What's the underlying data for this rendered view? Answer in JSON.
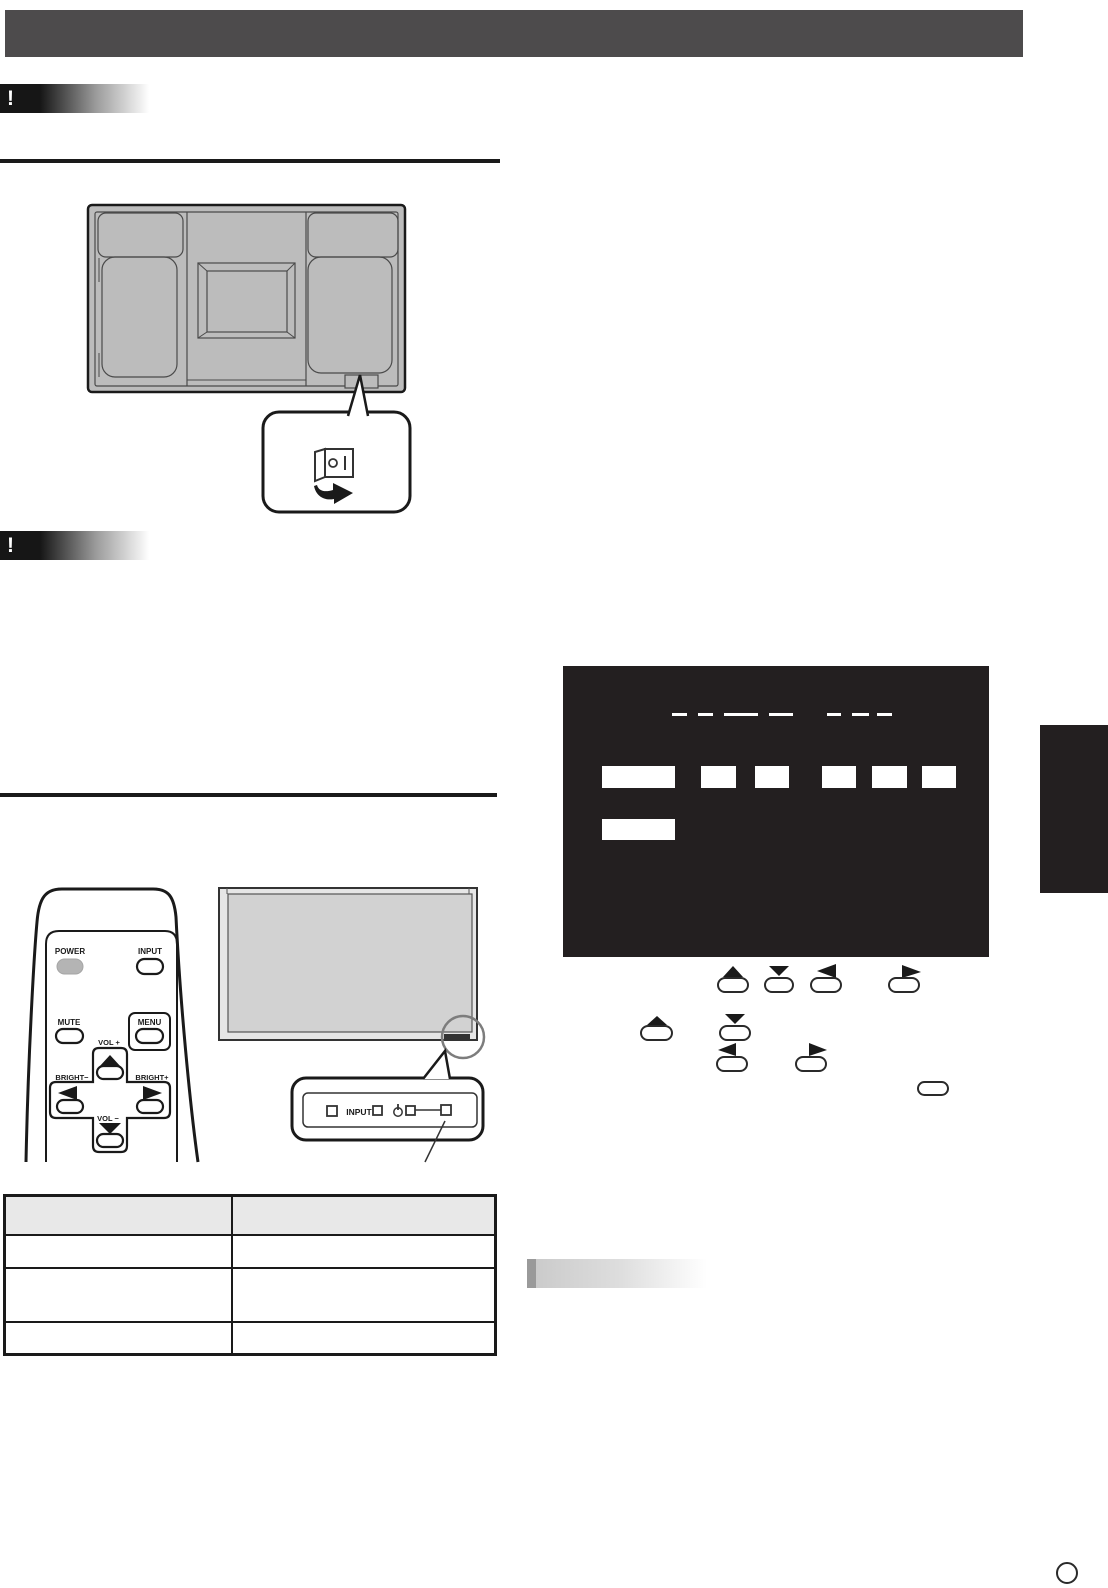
{
  "caution_badge_1": {
    "symbol": "!"
  },
  "caution_badge_2": {
    "symbol": "!"
  },
  "back_figure": {
    "power_switch_icon": "rocker-switch",
    "switch_off_glyph": "O",
    "switch_on_glyph": "I",
    "arrow_icon": "curved-right-arrow"
  },
  "remote": {
    "power": "POWER",
    "input": "INPUT",
    "mute": "MUTE",
    "menu": "MENU",
    "vol_plus": "VOL +",
    "vol_minus": "VOL −",
    "bright_minus": "BRIGHT−",
    "bright_plus": "BRIGHT+"
  },
  "front_panel": {
    "input_label": "INPUT",
    "power_icon": "power-symbol"
  },
  "status_table": {
    "header": [
      "",
      ""
    ],
    "rows": [
      [
        "",
        ""
      ],
      [
        "",
        ""
      ],
      [
        "",
        ""
      ]
    ]
  },
  "osd": {
    "background": "#231f20",
    "highlight_boxes": 8,
    "title_underline_segments": 7
  },
  "page_number": "",
  "colors": {
    "header_bar": "#4d4b4c",
    "osd_background": "#231f20",
    "section_tab": "#231f20",
    "table_header_bg": "#e8e8e8",
    "figure_gray": "#bcbcbc",
    "screen_gray": "#d2d2d2",
    "power_button_gray": "#b4b4b4"
  }
}
